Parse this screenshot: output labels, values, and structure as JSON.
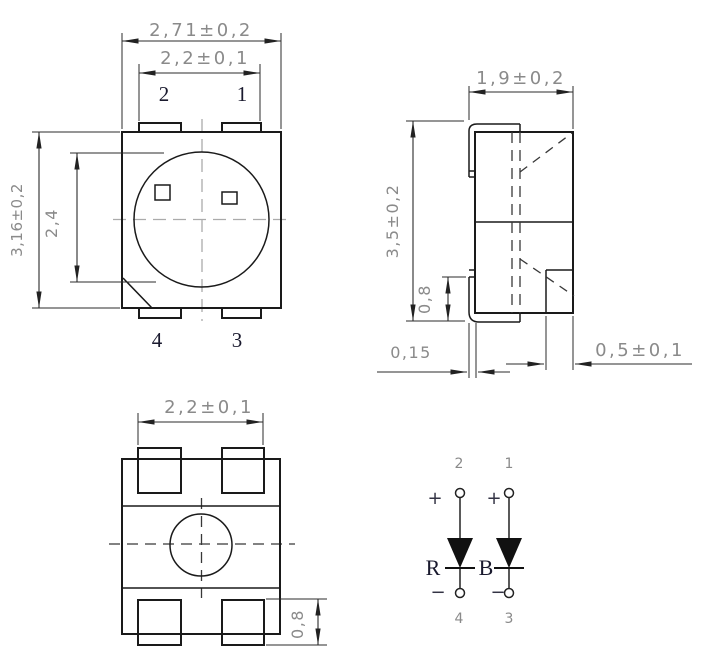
{
  "drawing_type": "SMD LED package dimensional drawing (PLCC-4, bi-color R/B)",
  "colors": {
    "line": "#1a1a1a",
    "dimension_text": "#8a8a8a",
    "pin_label": "#1a1a2e",
    "background": "#ffffff"
  },
  "front_view": {
    "outer_width": "2,71±0,2",
    "pad_span": "2,2±0,1",
    "overall_height": "3,16±0,2",
    "lens_diameter": "2,4",
    "pins": {
      "top_left": "2",
      "top_right": "1",
      "bottom_left": "4",
      "bottom_right": "3"
    }
  },
  "side_view": {
    "body_width": "1,9±0,2",
    "overall_height": "3,5±0,2",
    "lead_standoff": "0,8",
    "lead_thickness": "0,15",
    "pad_width": "0,5±0,1"
  },
  "bottom_view": {
    "pad_span": "2,2±0,1",
    "pad_height": "0,8"
  },
  "schematic": {
    "pins": {
      "top_left": "2",
      "top_right": "1",
      "bottom_left": "4",
      "bottom_right": "3"
    },
    "anode_sign": "+",
    "cathode_sign": "−",
    "left_diode": "R",
    "right_diode": "B"
  }
}
